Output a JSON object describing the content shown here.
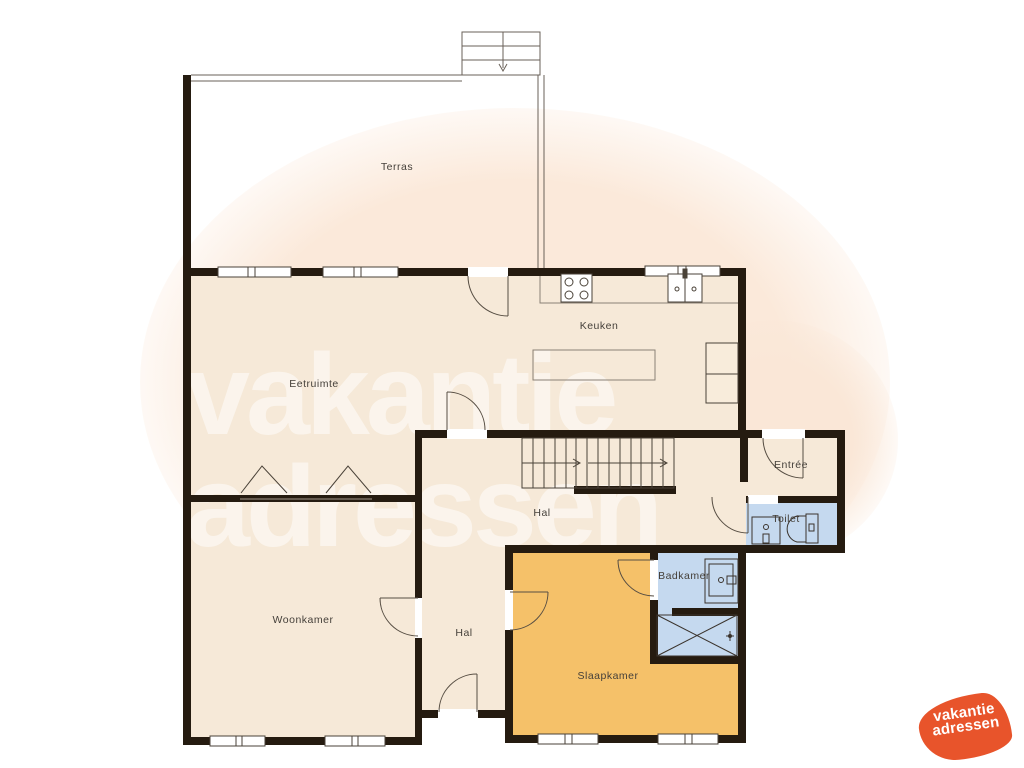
{
  "floorplan": {
    "rooms": {
      "terras": "Terras",
      "keuken": "Keuken",
      "eetruimte": "Eetruimte",
      "entree": "Entrée",
      "hal_boven": "Hal",
      "toilet": "Toilet",
      "badkamer": "Badkamer",
      "woonkamer": "Woonkamer",
      "hal_onder": "Hal",
      "slaapkamer": "Slaapkamer"
    },
    "colors": {
      "wall": "#251b10",
      "floor_cream": "#f6e9d8",
      "floor_orange": "#f5c169",
      "floor_blue": "#c5d9ef",
      "thin_line": "#574e43",
      "background_blob": "#fbe9da",
      "label_text": "#45403a"
    }
  },
  "watermark": {
    "line1": "vakantie",
    "line2": "adressen"
  },
  "logo": {
    "line1": "vakantie",
    "line2": "adressen",
    "color": "#e8542b"
  }
}
